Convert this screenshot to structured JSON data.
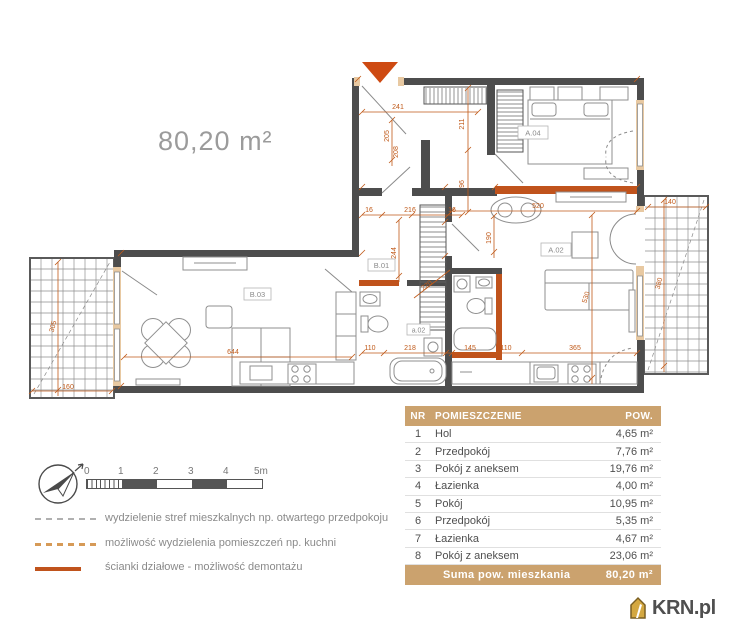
{
  "header": {
    "area_label": "80,20 m²"
  },
  "colors": {
    "accent_orange": "#c05a1a",
    "partition_orange": "#c0531c",
    "wall_gray": "#4d4d4d",
    "table_tan": "#cba26e",
    "logo_gold": "#d4a841"
  },
  "plan": {
    "labels": {
      "a04": "A.04",
      "a02": "A.02",
      "b01": "B.01",
      "b03": "B.03",
      "a02s": "a.02"
    },
    "dims": {
      "d241": "241",
      "d211": "211",
      "d96": "96",
      "d16a": "16",
      "d216": "216",
      "d16b": "16",
      "d244": "244",
      "d205": "205",
      "d208": "208",
      "d220": "220",
      "d520": "520",
      "d190": "190",
      "d530": "530",
      "d110a": "110",
      "d218": "218",
      "d145": "145",
      "d110b": "110",
      "d365": "365",
      "d644": "644",
      "d160": "160",
      "d305": "305",
      "d140": "140",
      "d380": "380"
    }
  },
  "scalebar": {
    "ticks": [
      "0",
      "1",
      "2",
      "3",
      "4",
      "5m"
    ]
  },
  "legend": {
    "items": [
      {
        "label": "wydzielenie stref mieszkalnych np. otwartego przedpokoju"
      },
      {
        "label": "możliwość wydzielenia pomieszczeń np. kuchni"
      },
      {
        "label": "ścianki działowe - możliwość demontażu"
      }
    ]
  },
  "table": {
    "headers": {
      "nr": "NR",
      "name": "POMIESZCZENIE",
      "area": "POW."
    },
    "rows": [
      {
        "nr": "1",
        "name": "Hol",
        "area": "4,65 m²"
      },
      {
        "nr": "2",
        "name": "Przedpokój",
        "area": "7,76 m²"
      },
      {
        "nr": "3",
        "name": "Pokój z aneksem",
        "area": "19,76 m²"
      },
      {
        "nr": "4",
        "name": "Łazienka",
        "area": "4,00 m²"
      },
      {
        "nr": "5",
        "name": "Pokój",
        "area": "10,95 m²"
      },
      {
        "nr": "6",
        "name": "Przedpokój",
        "area": "5,35 m²"
      },
      {
        "nr": "7",
        "name": "Łazienka",
        "area": "4,67 m²"
      },
      {
        "nr": "8",
        "name": "Pokój z aneksem",
        "area": "23,06 m²"
      }
    ],
    "footer": {
      "label": "Suma pow. mieszkania",
      "area": "80,20 m²"
    }
  },
  "logo": {
    "text": "KRN.pl"
  }
}
